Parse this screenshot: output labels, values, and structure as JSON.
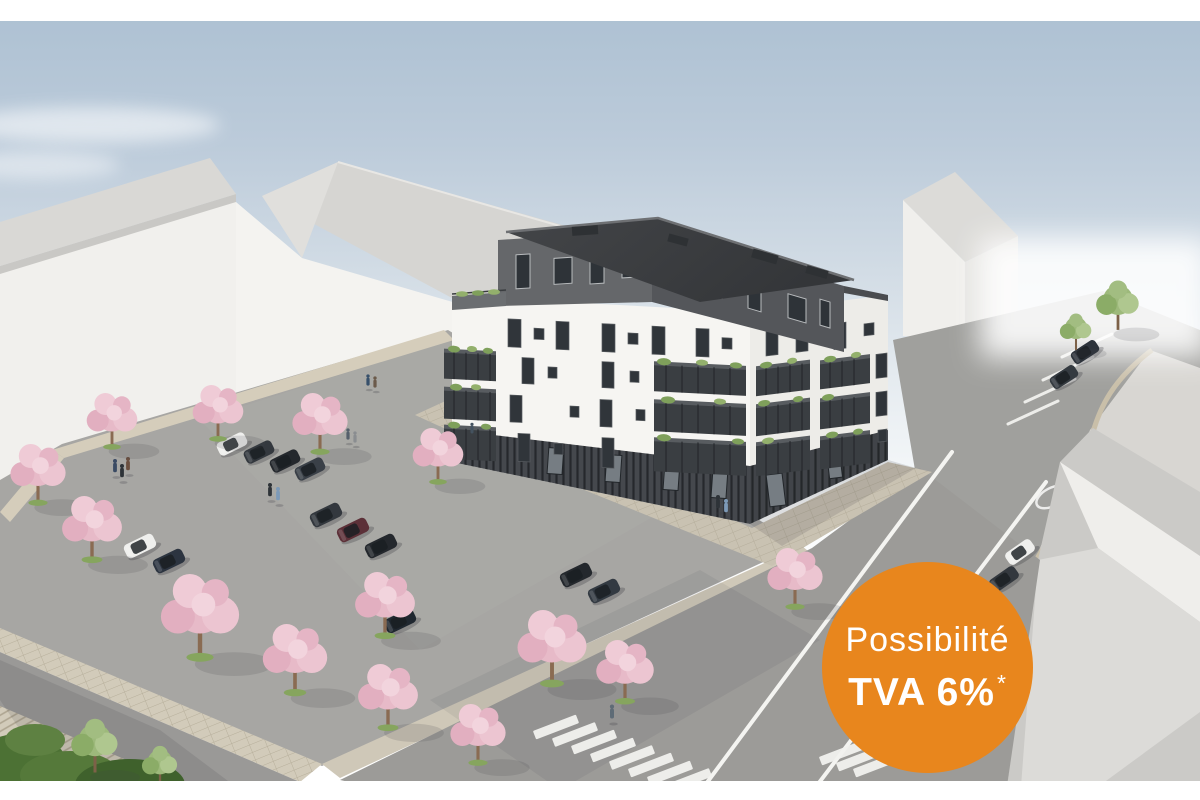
{
  "meta": {
    "kind": "architectural-rendering",
    "subject": "Aerial 3D render of a new white apartment residence with dark penthouse level, balconies, landscaped parking lot with flowering trees, streets and pedestrian crossing"
  },
  "badge": {
    "line1": "Possibilité",
    "line2": "TVA 6%",
    "footnote_marker": "*",
    "bg_color": "#E8861D",
    "text_color": "#FFFFFF"
  },
  "palette": {
    "sky_top": "#ACC0D2",
    "sky_horizon": "#F3F7F9",
    "facade_white": "#F6F5F2",
    "facade_shaded": "#EDECE8",
    "penthouse_dark": "#5D5F63",
    "roof_dark": "#3C3E41",
    "balcony_dark": "#3A3E42",
    "context_wall": "#F1F0ED",
    "context_roof": "#D8D7D4",
    "asphalt": "#A7A6A3",
    "road": "#9C9B98",
    "sidewalk_beige": "#D4CCBA",
    "plaza_gray": "#D8D6D2",
    "blossom_pink": "#E9BECB",
    "foliage_green": "#8FAD6E",
    "hedge_green": "#4C7134",
    "car_dark": "#33383E",
    "car_white": "#EFEFED",
    "car_red": "#5C3038"
  },
  "scene": {
    "blossom_trees": 14,
    "green_trees": 4,
    "cars": 15,
    "pedestrians": 12,
    "crosswalk": "zebra crossing at bottom centre",
    "white_margins": "thin white bands at top and bottom edges"
  }
}
